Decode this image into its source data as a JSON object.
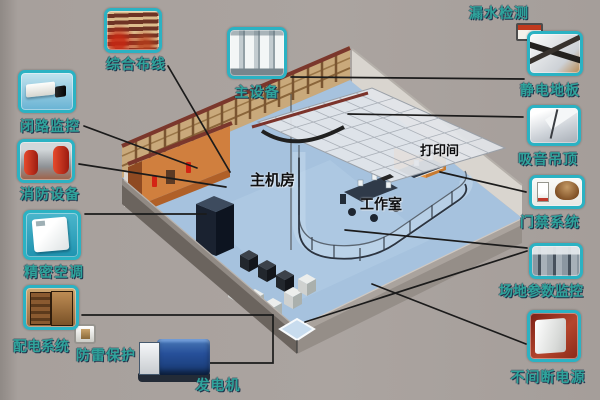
{
  "diagram": {
    "room_labels": {
      "machine_room": "主机房",
      "work_room": "工作室",
      "print_room": "打印间"
    },
    "callouts": [
      {
        "id": "integrated-cabling",
        "label": "综合布线"
      },
      {
        "id": "main-equipment",
        "label": "主设备"
      },
      {
        "id": "leak-detection",
        "label": "漏水检测"
      },
      {
        "id": "antistatic-floor",
        "label": "静电地板"
      },
      {
        "id": "acoustic-ceiling",
        "label": "吸音吊顶"
      },
      {
        "id": "access-control",
        "label": "门禁系统"
      },
      {
        "id": "site-monitoring",
        "label": "场地参数监控"
      },
      {
        "id": "ups",
        "label": "不间断电源"
      },
      {
        "id": "generator",
        "label": "发电机"
      },
      {
        "id": "lightning-protection",
        "label": "防雷保护"
      },
      {
        "id": "power-distribution",
        "label": "配电系统"
      },
      {
        "id": "precision-ac",
        "label": "精密空调"
      },
      {
        "id": "fire-equipment",
        "label": "消防设备"
      },
      {
        "id": "cctv",
        "label": "闭路监控"
      }
    ],
    "colors": {
      "background": "#a9a29e",
      "label_text": "#2fa39b",
      "thumb_border": "#2bb2c3",
      "connector_line": "#1b1b1b",
      "floor_blue": "#a6c2de",
      "wall_orange": "#d07f3e",
      "beam_maroon": "#7b372c"
    }
  }
}
